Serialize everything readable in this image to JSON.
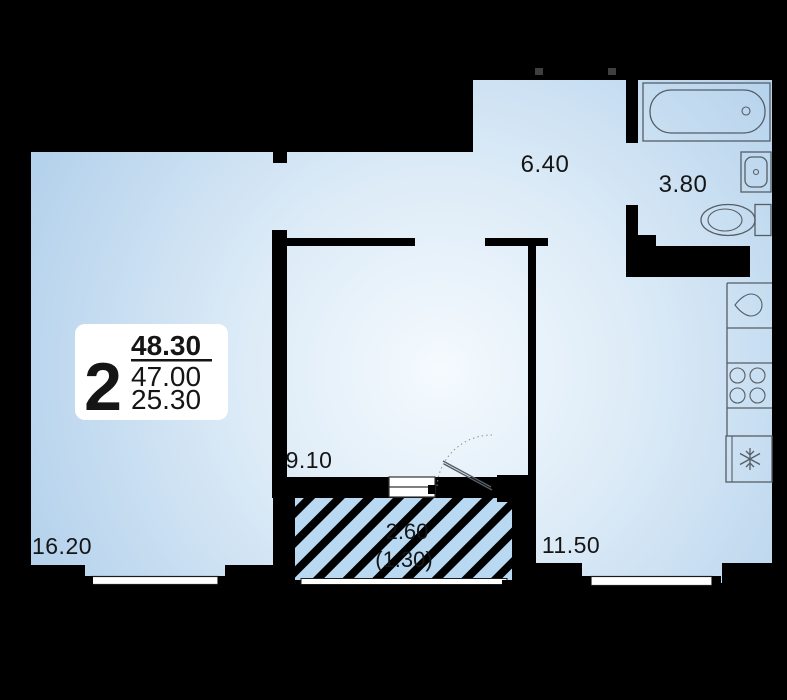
{
  "summary": {
    "room_count": "2",
    "total_area": "48.30",
    "area_without_summer": "47.00",
    "living_area": "25.30"
  },
  "rooms": [
    {
      "name": "living-room",
      "area": "16.20"
    },
    {
      "name": "bedroom",
      "area": "9.10"
    },
    {
      "name": "hallway",
      "area": "6.40"
    },
    {
      "name": "bathroom",
      "area": "3.80"
    },
    {
      "name": "kitchen-living-room",
      "area": "11.50"
    },
    {
      "name": "balcony",
      "area": "2.60",
      "area_with_coefficient": "(1.30)"
    }
  ],
  "fixtures": [
    "bathtub",
    "washbasin",
    "toilet",
    "kitchen-sink",
    "stove",
    "refrigerator",
    "balcony-door-swing",
    "window-sills"
  ],
  "colors": {
    "background": "#000000",
    "walls": "#000000",
    "floor_highlight": "#f5fafe",
    "floor_base": "#b5d2ec",
    "balcony_floor": "#b9d9f3",
    "fixture_outline": "#555e66",
    "info_box_bg": "#ffffff",
    "label_text": "#151515"
  }
}
